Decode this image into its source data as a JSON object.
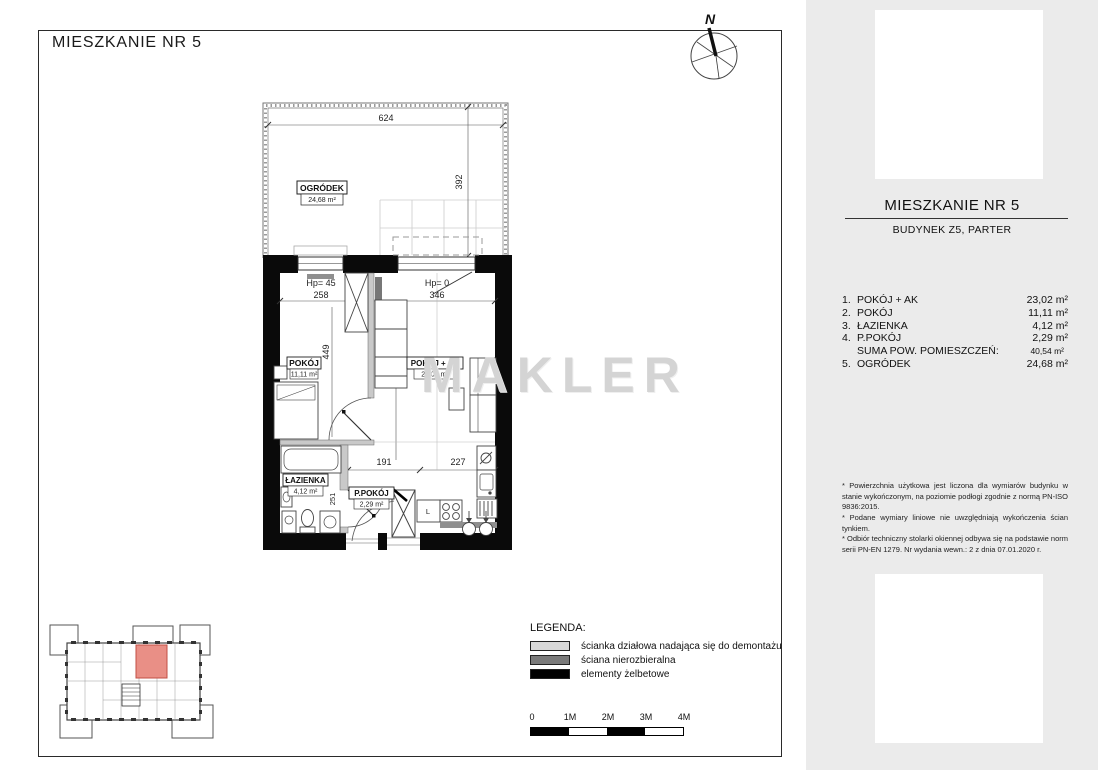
{
  "page": {
    "title": "MIESZKANIE NR 5",
    "watermark": "MAKLER",
    "compass": "N"
  },
  "plan": {
    "garden": {
      "name": "OGRÓDEK",
      "area": "24,68 m²"
    },
    "labels": {
      "pokoj": {
        "name": "POKÓJ",
        "area": "11,11 m²"
      },
      "pokoj_ak": {
        "name": "POKÓJ + AK",
        "area": "23,02 m²"
      },
      "lazienka": {
        "name": "ŁAZIENKA",
        "area": "4,12 m²"
      },
      "ppokoj": {
        "name": "P.POKÓJ",
        "area": "2,29 m²"
      }
    },
    "dims": {
      "garden_w": "624",
      "garden_d": "392",
      "hp_left": "Hp= 45",
      "w_left": "258",
      "t_partition": "8",
      "hp_right": "Hp= 0",
      "w_right": "346",
      "d_pokoj": "449",
      "d_living": "581",
      "tub": "186",
      "hall": "191",
      "kitchen": "227",
      "bath_wall": "12",
      "bath_d": "251",
      "hall_d": "123",
      "fridge": "L"
    }
  },
  "sidebar": {
    "title": "MIESZKANIE NR 5",
    "subtitle": "BUDYNEK Z5, PARTER",
    "rooms": [
      {
        "no": "1.",
        "name": "POKÓJ + AK",
        "area": "23,02 m²"
      },
      {
        "no": "2.",
        "name": "POKÓJ",
        "area": "11,11 m²"
      },
      {
        "no": "3.",
        "name": "ŁAZIENKA",
        "area": "4,12 m²"
      },
      {
        "no": "4.",
        "name": "P.POKÓJ",
        "area": "2,29 m²"
      },
      {
        "no": "",
        "name": "SUMA POW. POMIESZCZEŃ:",
        "area": "40,54 m²"
      },
      {
        "no": "5.",
        "name": "OGRÓDEK",
        "area": "24,68 m²"
      }
    ],
    "notes": [
      "* Powierzchnia użytkowa jest liczona dla wymiarów budynku w stanie wykończonym, na poziomie podłogi zgodnie z normą PN-ISO 9836:2015.",
      "* Podane wymiary liniowe nie uwzględniają wykończenia ścian tynkiem.",
      "* Odbiór techniczny stolarki okiennej odbywa się na podstawie norm serii PN-EN 1279. Nr wydania wewn.: 2 z dnia 07.01.2020 r."
    ]
  },
  "legend": {
    "title": "LEGENDA:",
    "items": [
      {
        "label": "ścianka działowa nadająca się do demontażu",
        "color": "#d9d9d9"
      },
      {
        "label": "ściana nierozbieralna",
        "color": "#7a7a7a"
      },
      {
        "label": "elementy żelbetowe",
        "color": "#000000"
      }
    ]
  },
  "scalebar": {
    "labels": [
      "0",
      "1M",
      "2M",
      "3M",
      "4M"
    ]
  },
  "colors": {
    "sidebar_bg": "#ebebeb",
    "highlight_unit": "#e98f86",
    "wall": "#0a0a0a",
    "partition": "#c9c9c9"
  }
}
